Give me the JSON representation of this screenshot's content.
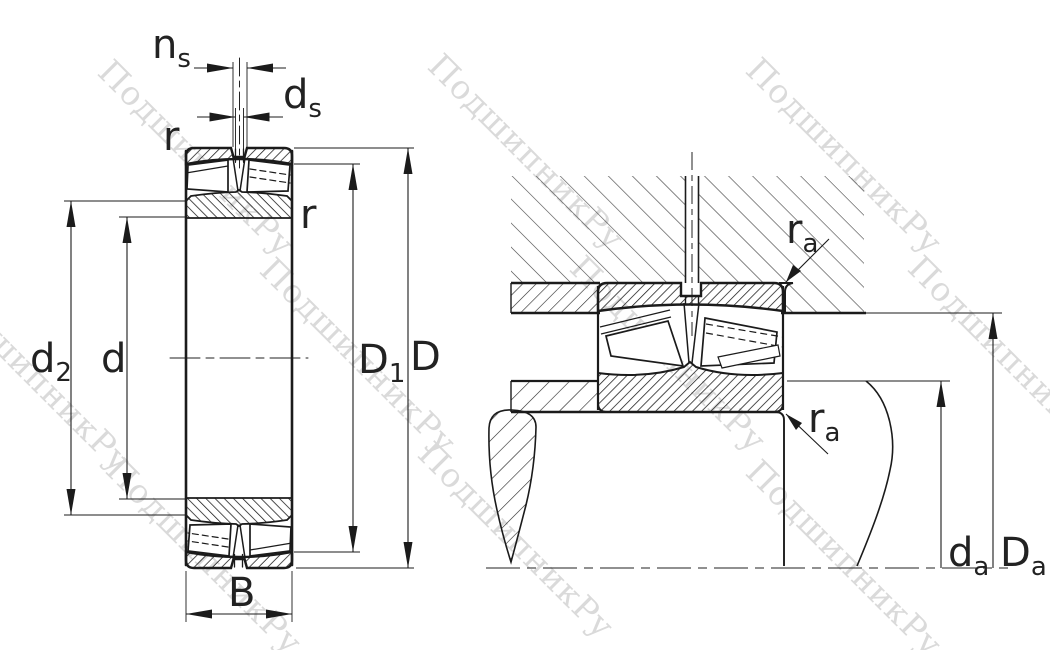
{
  "watermark": {
    "text": "ПодшипникРу"
  },
  "labels": {
    "ns": {
      "base": "n",
      "sub": "s"
    },
    "ds": {
      "base": "d",
      "sub": "s"
    },
    "r_top_left": "r",
    "r_right": "r",
    "d2": {
      "base": "d",
      "sub": "2"
    },
    "d": "d",
    "D1": {
      "base": "D",
      "sub": "1"
    },
    "D": "D",
    "B": "B",
    "ra_top": {
      "base": "r",
      "sub": "a"
    },
    "ra_bottom": {
      "base": "r",
      "sub": "a"
    },
    "da": {
      "base": "d",
      "sub": "a"
    },
    "Da": {
      "base": "D",
      "sub": "a"
    }
  },
  "colors": {
    "line": "#1b1b1b",
    "housing_hatch": "#3d3d3d",
    "watermark": "#dadada",
    "background": "#ffffff"
  }
}
